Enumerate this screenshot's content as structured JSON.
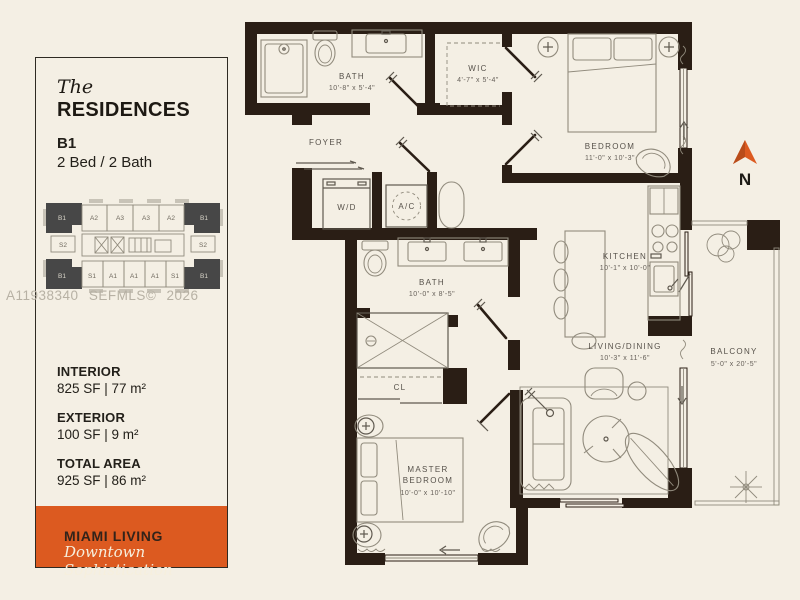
{
  "panel": {
    "brand_prefix": "The",
    "brand_name": "RESIDENCES",
    "unit_code": "B1",
    "unit_type": "2 Bed / 2 Bath",
    "keyplan_units": [
      "B1",
      "A2",
      "A3",
      "A3",
      "A2",
      "B1",
      "S2",
      "S2",
      "B1",
      "S1",
      "A1",
      "A1",
      "A1",
      "S1",
      "B1"
    ],
    "stats": [
      {
        "label": "INTERIOR",
        "value": "825 SF | 77 m²"
      },
      {
        "label": "EXTERIOR",
        "value": "100 SF | 9 m²"
      },
      {
        "label": "TOTAL AREA",
        "value": "925 SF | 86 m²"
      }
    ],
    "tagline_title": "MIAMI LIVING",
    "tagline_subtitle": "Downtown Sophistication"
  },
  "watermark": "A11938340 SEFMLS© 2026",
  "colors": {
    "accent_orange": "#dc5a20",
    "wall": "#2a1e15",
    "background": "#f4efe4"
  },
  "floorplan": {
    "compass_label": "N",
    "rooms": {
      "bath1": {
        "name": "BATH",
        "dims": "10'-8\" x 5'-4\""
      },
      "wic": {
        "name": "WIC",
        "dims": "4'-7\" x 5'-4\""
      },
      "bedroom": {
        "name": "BEDROOM",
        "dims": "11'-0\" x 10'-3\""
      },
      "foyer": {
        "name": "FOYER"
      },
      "washer_dryer": {
        "name": "W/D"
      },
      "ac_closet": {
        "name": "A/C"
      },
      "bath2": {
        "name": "BATH",
        "dims": "10'-0\" x 8'-5\""
      },
      "kitchen": {
        "name": "KITCHEN",
        "dims": "10'-1\" x 10'-0\""
      },
      "living_dining": {
        "name": "LIVING/DINING",
        "dims": "10'-3\" x 11'-6\""
      },
      "closet": {
        "name": "CL"
      },
      "master_bedroom": {
        "name_line1": "MASTER",
        "name_line2": "BEDROOM",
        "dims": "10'-0\" x 10'-10\""
      },
      "balcony": {
        "name": "BALCONY",
        "dims": "5'-0\" x 20'-5\""
      }
    }
  }
}
